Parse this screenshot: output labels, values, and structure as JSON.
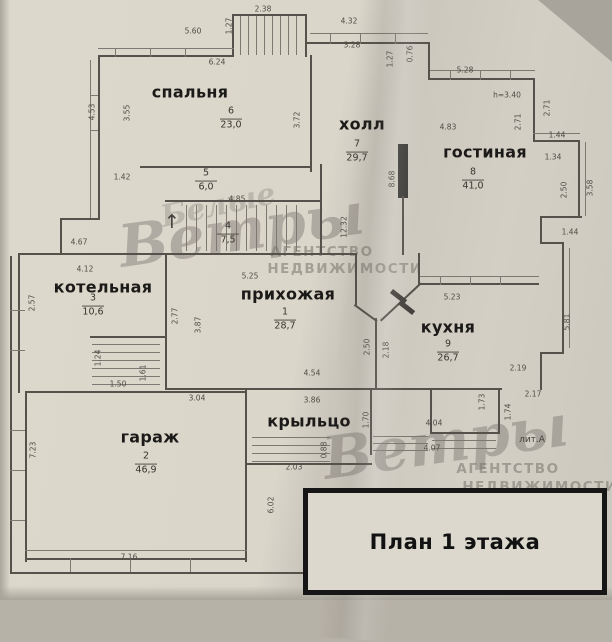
{
  "title_block": {
    "label": "План 1 этажа"
  },
  "watermark": {
    "script_small": "Белые",
    "script": "Ветры",
    "agency_line1": "АГЕНТСТВО",
    "agency_line2": "НЕДВИЖИМОСТИ"
  },
  "plan_labels": [
    {
      "text": "лит.А",
      "x": 532,
      "y": 440
    }
  ],
  "rooms": [
    {
      "name": "прихожая",
      "number": "1",
      "area": "28,7",
      "nx": 288,
      "ny": 294,
      "sx": 285,
      "sy": 320
    },
    {
      "name": "гараж",
      "number": "2",
      "area": "46,9",
      "nx": 150,
      "ny": 437,
      "sx": 146,
      "sy": 464
    },
    {
      "name": "котельная",
      "number": "3",
      "area": "10,6",
      "nx": 103,
      "ny": 287,
      "sx": 93,
      "sy": 306
    },
    {
      "name": null,
      "number": "4",
      "area": "7,5",
      "sx": 228,
      "sy": 234
    },
    {
      "name": null,
      "number": "5",
      "area": "6,0",
      "sx": 206,
      "sy": 181
    },
    {
      "name": "спальня",
      "number": "6",
      "area": "23,0",
      "nx": 190,
      "ny": 92,
      "sx": 231,
      "sy": 119
    },
    {
      "name": "холл",
      "number": "7",
      "area": "29,7",
      "nx": 362,
      "ny": 124,
      "sx": 357,
      "sy": 152
    },
    {
      "name": "гостиная",
      "number": "8",
      "area": "41,0",
      "nx": 485,
      "ny": 152,
      "sx": 473,
      "sy": 180
    },
    {
      "name": "кухня",
      "number": "9",
      "area": "26,7",
      "nx": 448,
      "ny": 327,
      "sx": 448,
      "sy": 352
    },
    {
      "name": "крыльцо",
      "number": null,
      "area": null,
      "nx": 309,
      "ny": 421
    }
  ],
  "dimensions": [
    {
      "t": "5.60",
      "x": 193,
      "y": 31,
      "r": 0
    },
    {
      "t": "2.38",
      "x": 263,
      "y": 9,
      "r": 0
    },
    {
      "t": "1.27",
      "x": 229,
      "y": 26,
      "r": 1
    },
    {
      "t": "6.24",
      "x": 217,
      "y": 62,
      "r": 0
    },
    {
      "t": "4.32",
      "x": 349,
      "y": 21,
      "r": 0
    },
    {
      "t": "3.28",
      "x": 352,
      "y": 45,
      "r": 0
    },
    {
      "t": "1.27",
      "x": 390,
      "y": 59,
      "r": 1
    },
    {
      "t": "0.76",
      "x": 410,
      "y": 54,
      "r": 1
    },
    {
      "t": "5.28",
      "x": 465,
      "y": 70,
      "r": 0
    },
    {
      "t": "h=3.40",
      "x": 507,
      "y": 95,
      "r": 0
    },
    {
      "t": "2.71",
      "x": 547,
      "y": 108,
      "r": 1
    },
    {
      "t": "2.71",
      "x": 518,
      "y": 122,
      "r": 1
    },
    {
      "t": "4.83",
      "x": 448,
      "y": 127,
      "r": 0
    },
    {
      "t": "1.44",
      "x": 557,
      "y": 135,
      "r": 0
    },
    {
      "t": "1.34",
      "x": 553,
      "y": 157,
      "r": 0
    },
    {
      "t": "2.50",
      "x": 564,
      "y": 190,
      "r": 1
    },
    {
      "t": "3.58",
      "x": 590,
      "y": 188,
      "r": 1
    },
    {
      "t": "1.44",
      "x": 570,
      "y": 232,
      "r": 0
    },
    {
      "t": "8.68",
      "x": 392,
      "y": 179,
      "r": 1
    },
    {
      "t": "4.53",
      "x": 92,
      "y": 112,
      "r": 1
    },
    {
      "t": "3.55",
      "x": 127,
      "y": 113,
      "r": 1
    },
    {
      "t": "3.72",
      "x": 297,
      "y": 120,
      "r": 1
    },
    {
      "t": "1.42",
      "x": 122,
      "y": 177,
      "r": 0
    },
    {
      "t": "4.85",
      "x": 237,
      "y": 199,
      "r": 0
    },
    {
      "t": "4.67",
      "x": 79,
      "y": 242,
      "r": 0
    },
    {
      "t": "4.12",
      "x": 85,
      "y": 269,
      "r": 0
    },
    {
      "t": "2.57",
      "x": 32,
      "y": 303,
      "r": 1
    },
    {
      "t": "2.77",
      "x": 175,
      "y": 316,
      "r": 1
    },
    {
      "t": "3.87",
      "x": 198,
      "y": 325,
      "r": 1
    },
    {
      "t": "5.25",
      "x": 250,
      "y": 276,
      "r": 0
    },
    {
      "t": "12.32",
      "x": 344,
      "y": 227,
      "r": 1
    },
    {
      "t": "2.50",
      "x": 367,
      "y": 347,
      "r": 1
    },
    {
      "t": "2.18",
      "x": 386,
      "y": 350,
      "r": 1
    },
    {
      "t": "5.23",
      "x": 452,
      "y": 297,
      "r": 0
    },
    {
      "t": "5.81",
      "x": 567,
      "y": 322,
      "r": 1
    },
    {
      "t": "2.19",
      "x": 518,
      "y": 368,
      "r": 0
    },
    {
      "t": "2.17",
      "x": 533,
      "y": 394,
      "r": 0
    },
    {
      "t": "1.73",
      "x": 482,
      "y": 402,
      "r": 1
    },
    {
      "t": "1.74",
      "x": 508,
      "y": 412,
      "r": 1
    },
    {
      "t": "4.04",
      "x": 434,
      "y": 423,
      "r": 0
    },
    {
      "t": "4.07",
      "x": 432,
      "y": 448,
      "r": 0
    },
    {
      "t": "4.54",
      "x": 312,
      "y": 373,
      "r": 0
    },
    {
      "t": "3.86",
      "x": 312,
      "y": 400,
      "r": 0
    },
    {
      "t": "1.70",
      "x": 366,
      "y": 420,
      "r": 1
    },
    {
      "t": "2.03",
      "x": 294,
      "y": 467,
      "r": 0
    },
    {
      "t": "0.88",
      "x": 324,
      "y": 450,
      "r": 1
    },
    {
      "t": "6.02",
      "x": 271,
      "y": 505,
      "r": 1
    },
    {
      "t": "1.24",
      "x": 98,
      "y": 358,
      "r": 1
    },
    {
      "t": "1.50",
      "x": 118,
      "y": 384,
      "r": 0
    },
    {
      "t": "1.61",
      "x": 143,
      "y": 373,
      "r": 1
    },
    {
      "t": "3.04",
      "x": 197,
      "y": 398,
      "r": 0
    },
    {
      "t": "7.23",
      "x": 33,
      "y": 450,
      "r": 1
    },
    {
      "t": "7.16",
      "x": 129,
      "y": 557,
      "r": 0
    }
  ]
}
